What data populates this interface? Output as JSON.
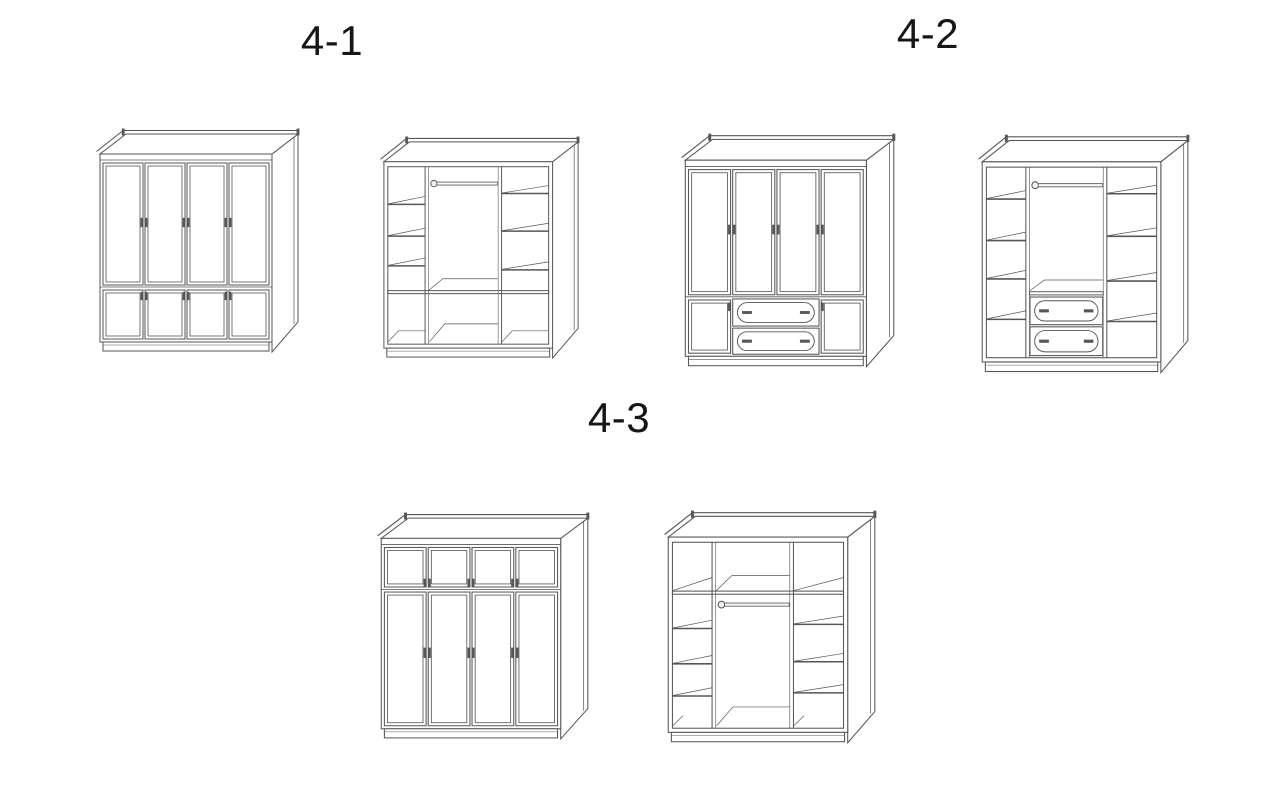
{
  "style": {
    "background": "#ffffff",
    "line_color": "#565656",
    "label_color": "#161616"
  },
  "groups": [
    {
      "label": "4-1",
      "views": [
        {
          "name": "wardrobe-4-1-closed",
          "kind": "exterior-tall-doors-over-short-doors"
        },
        {
          "name": "wardrobe-4-1-open",
          "kind": "interior-rod-shelves-open-base"
        }
      ]
    },
    {
      "label": "4-2",
      "views": [
        {
          "name": "wardrobe-4-2-closed",
          "kind": "exterior-tall-doors-over-drawers"
        },
        {
          "name": "wardrobe-4-2-open",
          "kind": "interior-rod-shelves-drawers"
        }
      ]
    },
    {
      "label": "4-3",
      "views": [
        {
          "name": "wardrobe-4-3-closed",
          "kind": "exterior-short-doors-over-tall-doors"
        },
        {
          "name": "wardrobe-4-3-open",
          "kind": "interior-top-compartments-rod-shelves"
        }
      ]
    }
  ]
}
